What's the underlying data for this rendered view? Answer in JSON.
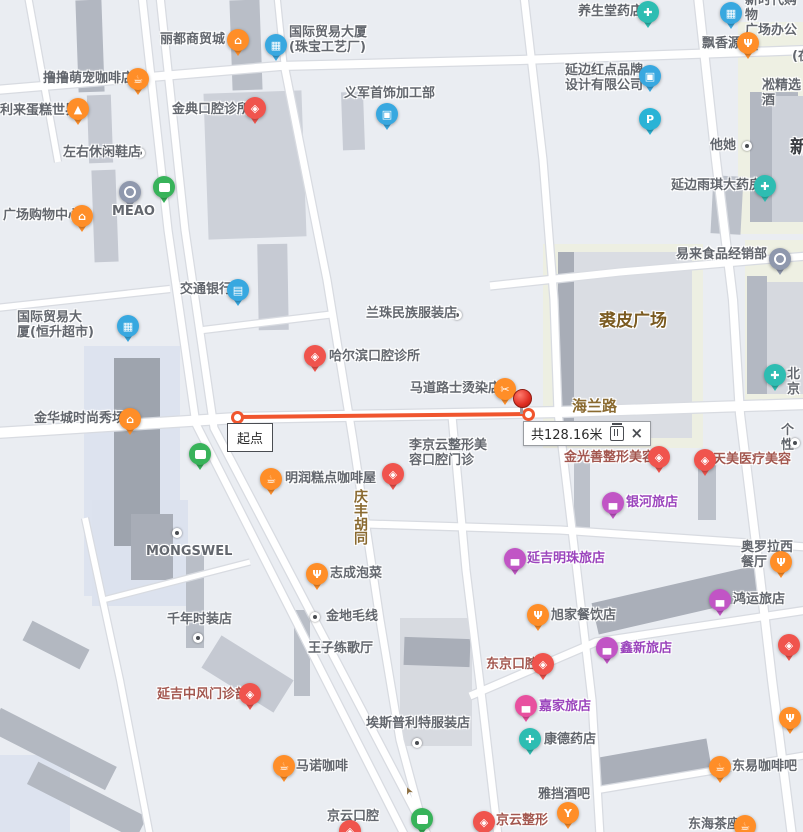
{
  "map": {
    "background": "#eaedf2",
    "road_fill": "#ffffff",
    "road_casing": "#d8dbe1",
    "palette": {
      "orange": "#ff8e28",
      "red": "#f0544d",
      "blue": "#38a8e0",
      "teal": "#2ebdb2",
      "tealP": "#2ab3d6",
      "green": "#38b35a",
      "purple": "#c155c5",
      "pink": "#e8509f",
      "grayblue": "#8f98ad"
    },
    "text_colors": {
      "gray": "#63676e",
      "purple": "#9b45bd",
      "medical": "#a3574f",
      "road": "#8a6a30",
      "plaza": "#7a5a20",
      "dark": "#3a3d42"
    }
  },
  "measurement": {
    "start_label": "起点",
    "distance_label": "共128.16米",
    "close_label": "×",
    "line_color": "#f0552e",
    "line": {
      "x1": 237,
      "y1": 417,
      "x2": 528,
      "y2": 414
    },
    "pushpin": {
      "x": 521,
      "y": 398
    }
  },
  "arrow": {
    "x": 405,
    "y": 785,
    "rot": -115,
    "glyph": "➤"
  },
  "icon_glyphs": {
    "bag": "⌂",
    "coffee": "☕",
    "cake": "▲",
    "restaurant": "Ψ",
    "scissors": "✂",
    "dental": "◈",
    "building": "▦",
    "briefcase": "▣",
    "card": "▤",
    "cross": "✚",
    "firstaid": "✚",
    "parking": "P",
    "bed": "▄",
    "cocktail": "Y"
  },
  "lots": [
    {
      "x": 543,
      "y": 244,
      "w": 160,
      "h": 204,
      "c": "#edefe2"
    },
    {
      "x": 738,
      "y": 22,
      "w": 65,
      "h": 212,
      "c": "#eef0e3"
    },
    {
      "x": 745,
      "y": 240,
      "w": 58,
      "h": 160,
      "c": "#eef0e3"
    },
    {
      "x": 84,
      "y": 346,
      "w": 96,
      "h": 250,
      "c": "#dde3ef"
    },
    {
      "x": 92,
      "y": 500,
      "w": 96,
      "h": 106,
      "c": "#dce2ee"
    },
    {
      "x": 0,
      "y": 755,
      "w": 70,
      "h": 77,
      "c": "#dde3ef"
    }
  ],
  "buildings": [
    {
      "x": 77,
      "y": 0,
      "w": 26,
      "h": 92,
      "c": "#b2b7c1",
      "r": -2
    },
    {
      "x": 231,
      "y": 0,
      "w": 30,
      "h": 90,
      "c": "#b9bec7",
      "r": -2
    },
    {
      "x": 88,
      "y": 95,
      "w": 24,
      "h": 68,
      "c": "#c5c9d2",
      "r": -2
    },
    {
      "x": 93,
      "y": 170,
      "w": 24,
      "h": 92,
      "c": "#c5c9d2",
      "r": -2
    },
    {
      "x": 206,
      "y": 92,
      "w": 98,
      "h": 146,
      "c": "#cdd1d9",
      "r": -2
    },
    {
      "x": 258,
      "y": 244,
      "w": 30,
      "h": 86,
      "c": "#c6cad3",
      "r": -1
    },
    {
      "x": 342,
      "y": 92,
      "w": 22,
      "h": 58,
      "c": "#c8ccd5",
      "r": -2
    },
    {
      "x": 558,
      "y": 252,
      "w": 16,
      "h": 186,
      "c": "#a8adb7",
      "r": 0
    },
    {
      "x": 574,
      "y": 252,
      "w": 118,
      "h": 186,
      "c": "#dadde3",
      "r": 0
    },
    {
      "x": 750,
      "y": 92,
      "w": 48,
      "h": 130,
      "c": "#b2b7c1",
      "r": 0
    },
    {
      "x": 772,
      "y": 96,
      "w": 31,
      "h": 126,
      "c": "#cdd1d9",
      "r": 0
    },
    {
      "x": 747,
      "y": 276,
      "w": 20,
      "h": 118,
      "c": "#b3b8c2",
      "r": 0
    },
    {
      "x": 767,
      "y": 282,
      "w": 36,
      "h": 112,
      "c": "#d6d9df",
      "r": 0
    },
    {
      "x": 712,
      "y": 176,
      "w": 30,
      "h": 58,
      "c": "#bcc1ca",
      "r": 3
    },
    {
      "x": 114,
      "y": 358,
      "w": 46,
      "h": 188,
      "c": "#9ea4ae",
      "r": 0
    },
    {
      "x": 131,
      "y": 514,
      "w": 42,
      "h": 66,
      "c": "#a8adb7",
      "r": 0
    },
    {
      "x": 186,
      "y": 552,
      "w": 18,
      "h": 96,
      "c": "#b9bec7",
      "r": 0
    },
    {
      "x": 294,
      "y": 610,
      "w": 16,
      "h": 86,
      "c": "#b9bec7",
      "r": 0
    },
    {
      "x": 400,
      "y": 618,
      "w": 72,
      "h": 128,
      "c": "#d7dae0",
      "r": 0
    },
    {
      "x": 404,
      "y": 638,
      "w": 66,
      "h": 28,
      "c": "#a9aeb8",
      "r": 2
    },
    {
      "x": 593,
      "y": 584,
      "w": 168,
      "h": 32,
      "c": "#aaafb9",
      "r": -13
    },
    {
      "x": 598,
      "y": 748,
      "w": 112,
      "h": 32,
      "c": "#aaafb9",
      "r": -10
    },
    {
      "x": 574,
      "y": 452,
      "w": 16,
      "h": 80,
      "c": "#bcc1ca",
      "r": 0
    },
    {
      "x": 698,
      "y": 464,
      "w": 18,
      "h": 56,
      "c": "#bcc1ca",
      "r": 0
    },
    {
      "x": 205,
      "y": 655,
      "w": 85,
      "h": 38,
      "c": "#c5c9d2",
      "r": 32
    },
    {
      "x": -12,
      "y": 736,
      "w": 130,
      "h": 26,
      "c": "#b3b8c1",
      "r": 27
    },
    {
      "x": 26,
      "y": 788,
      "w": 122,
      "h": 25,
      "c": "#b3b8c1",
      "r": 27
    },
    {
      "x": 24,
      "y": 634,
      "w": 64,
      "h": 22,
      "c": "#b3b8c1",
      "r": 27
    }
  ],
  "roads": [
    {
      "d": "M 28,-4 L 58,162",
      "w": 6
    },
    {
      "d": "M 142,-4 L 168,230 L 196,424 L 405,836",
      "w": 7
    },
    {
      "d": "M 160,-4 L 185,230 L 214,428 L 428,836",
      "w": 7
    },
    {
      "d": "M 277,-4 L 284,64",
      "w": 5
    },
    {
      "d": "M 284,64 L 327,280 L 353,440 L 380,620 L 400,740 L 426,836",
      "w": 7
    },
    {
      "d": "M 452,416 L 466,570 L 482,700 L 498,836",
      "w": 7
    },
    {
      "d": "M 524,-4 L 543,160 L 554,300 L 558,412",
      "w": 7
    },
    {
      "d": "M 558,412 L 578,580 L 592,700 L 600,836",
      "w": 7
    },
    {
      "d": "M 698,-4 L 716,160 L 733,300 L 740,414 L 758,560 L 772,680 L 792,836",
      "w": 8
    },
    {
      "d": "M -4,90 L 280,66 L 520,60 L 807,50",
      "w": 8
    },
    {
      "d": "M -4,433 L 237,418 L 560,412 L 807,404",
      "w": 10
    },
    {
      "d": "M 490,286 L 620,272 L 807,256",
      "w": 7
    },
    {
      "d": "M 367,524 L 560,530 L 807,547",
      "w": 7
    },
    {
      "d": "M 470,696 L 596,642 L 807,610",
      "w": 7
    },
    {
      "d": "M 598,790 L 807,755",
      "w": 6
    },
    {
      "d": "M 203,330 L 335,314",
      "w": 6
    },
    {
      "d": "M -4,308 L 170,289",
      "w": 6
    },
    {
      "d": "M 85,518 L 120,680 L 150,836",
      "w": 6
    },
    {
      "d": "M 103,600 L 250,562",
      "w": 5
    }
  ],
  "pois": [
    {
      "type": "pin",
      "label": "丽都商贸城",
      "icon": "bag",
      "pin": "orange",
      "tc": "gray",
      "x": 238,
      "y": 40,
      "lx": 160,
      "ly": 32
    },
    {
      "type": "pin",
      "label": "国际贸易大厦\n(珠宝工艺厂)",
      "icon": "building",
      "pin": "blue",
      "tc": "gray",
      "x": 276,
      "y": 45,
      "lx": 289,
      "ly": 25
    },
    {
      "type": "pin",
      "label": "养生堂药店",
      "icon": "cross",
      "pin": "teal",
      "tc": "gray",
      "x": 648,
      "y": 12,
      "lx": 578,
      "ly": 4
    },
    {
      "type": "pin",
      "label": "新时代购物\n广场办公区",
      "icon": "building",
      "pin": "blue",
      "tc": "gray",
      "x": 731,
      "y": 13,
      "lx": 745,
      "ly": -7
    },
    {
      "type": "pin",
      "label": "飘香源",
      "icon": "restaurant",
      "pin": "orange",
      "tc": "gray",
      "x": 748,
      "y": 43,
      "lx": 702,
      "ly": 36
    },
    {
      "type": "pin",
      "label": "撸撸萌宠咖啡店",
      "icon": "coffee",
      "pin": "orange",
      "tc": "gray",
      "x": 138,
      "y": 79,
      "lx": 43,
      "ly": 71
    },
    {
      "type": "pin",
      "label": "延边红点品牌\n设计有限公司",
      "icon": "briefcase",
      "pin": "blue",
      "tc": "gray",
      "x": 650,
      "y": 76,
      "lx": 565,
      "ly": 63
    },
    {
      "type": "pin",
      "label": "利来蛋糕世界",
      "icon": "cake",
      "pin": "orange",
      "tc": "gray",
      "x": 78,
      "y": 109,
      "lx": 0,
      "ly": 103
    },
    {
      "type": "pin",
      "label": "金典口腔诊所",
      "icon": "dental",
      "pin": "red",
      "tc": "gray",
      "x": 255,
      "y": 108,
      "lx": 172,
      "ly": 102
    },
    {
      "type": "pin",
      "label": "义军首饰加工部",
      "icon": "briefcase",
      "pin": "blue",
      "tc": "gray",
      "x": 387,
      "y": 114,
      "lx": 344,
      "ly": 86
    },
    {
      "type": "pin",
      "label": "",
      "icon": "parking",
      "pin": "tealP",
      "tc": "gray",
      "x": 650,
      "y": 119,
      "lx": 0,
      "ly": 0
    },
    {
      "type": "dot",
      "label": "左右休闲鞋店",
      "tc": "gray",
      "x": 140,
      "y": 153,
      "lx": 63,
      "ly": 145
    },
    {
      "type": "dot",
      "label": "他她",
      "tc": "gray",
      "x": 747,
      "y": 146,
      "lx": 710,
      "ly": 138
    },
    {
      "type": "pin",
      "label": "",
      "icon": "bus",
      "pin": "green",
      "tc": "gray",
      "x": 164,
      "y": 187,
      "lx": 0,
      "ly": 0
    },
    {
      "type": "pin",
      "label": "MEAO",
      "icon": "circlemark",
      "pin": "grayblue",
      "tc": "gray",
      "x": 130,
      "y": 192,
      "lx": 112,
      "ly": 204
    },
    {
      "type": "pin",
      "label": "广场购物中心",
      "icon": "bag",
      "pin": "orange",
      "tc": "gray",
      "x": 82,
      "y": 216,
      "lx": 3,
      "ly": 208
    },
    {
      "type": "pin",
      "label": "延边雨琪大药房",
      "icon": "firstaid",
      "pin": "teal",
      "tc": "gray",
      "x": 765,
      "y": 186,
      "lx": 671,
      "ly": 178
    },
    {
      "type": "pin",
      "label": "交通银行",
      "icon": "card",
      "pin": "blue",
      "tc": "gray",
      "x": 238,
      "y": 290,
      "lx": 180,
      "ly": 282
    },
    {
      "type": "pin",
      "label": "国际贸易大\n厦(恒升超市)",
      "icon": "building",
      "pin": "blue",
      "tc": "gray",
      "x": 128,
      "y": 326,
      "lx": 17,
      "ly": 310
    },
    {
      "type": "pin",
      "label": "易来食品经销部",
      "icon": "circlemark",
      "pin": "grayblue",
      "tc": "gray",
      "x": 780,
      "y": 259,
      "lx": 676,
      "ly": 247
    },
    {
      "type": "dot",
      "label": "兰珠民族服装店",
      "tc": "gray",
      "x": 457,
      "y": 315,
      "lx": 366,
      "ly": 306
    },
    {
      "type": "pin",
      "label": "哈尔滨口腔诊所",
      "icon": "dental",
      "pin": "red",
      "tc": "gray",
      "x": 315,
      "y": 356,
      "lx": 329,
      "ly": 349
    },
    {
      "type": "pin",
      "label": "北京",
      "icon": "firstaid",
      "pin": "teal",
      "tc": "gray",
      "x": 775,
      "y": 375,
      "lx": 787,
      "ly": 367
    },
    {
      "type": "pin",
      "label": "马道路士烫染店",
      "icon": "scissors",
      "pin": "orange",
      "tc": "gray",
      "x": 505,
      "y": 389,
      "lx": 410,
      "ly": 381
    },
    {
      "type": "pin",
      "label": "金华城时尚秀场",
      "icon": "bag",
      "pin": "orange",
      "tc": "gray",
      "x": 130,
      "y": 419,
      "lx": 34,
      "ly": 411
    },
    {
      "type": "pin",
      "label": "",
      "icon": "bus",
      "pin": "green",
      "tc": "gray",
      "x": 200,
      "y": 454,
      "lx": 0,
      "ly": 0
    },
    {
      "type": "pin",
      "label": "金光善整形美容",
      "icon": "dental",
      "pin": "red",
      "tc": "medical",
      "x": 659,
      "y": 457,
      "lx": 564,
      "ly": 450
    },
    {
      "type": "pin",
      "label": "天美医疗美容",
      "icon": "dental",
      "pin": "red",
      "tc": "medical",
      "x": 705,
      "y": 460,
      "lx": 713,
      "ly": 452
    },
    {
      "type": "pin",
      "label": "李京云整形美\n容口腔门诊",
      "icon": "dental",
      "pin": "red",
      "tc": "gray",
      "x": 393,
      "y": 474,
      "lx": 409,
      "ly": 438
    },
    {
      "type": "pin",
      "label": "明润糕点咖啡屋",
      "icon": "coffee",
      "pin": "orange",
      "tc": "gray",
      "x": 271,
      "y": 479,
      "lx": 285,
      "ly": 471
    },
    {
      "type": "pin",
      "label": "银河旅店",
      "icon": "bed",
      "pin": "purple",
      "tc": "purple",
      "x": 613,
      "y": 503,
      "lx": 626,
      "ly": 495
    },
    {
      "type": "pin",
      "label": "奥罗拉西餐厅",
      "icon": "restaurant",
      "pin": "orange",
      "tc": "gray",
      "x": 781,
      "y": 562,
      "lx": 741,
      "ly": 540
    },
    {
      "type": "pin",
      "label": "延吉明珠旅店",
      "icon": "bed",
      "pin": "purple",
      "tc": "purple",
      "x": 515,
      "y": 559,
      "lx": 527,
      "ly": 551
    },
    {
      "type": "dot",
      "label": "MONGSWEL",
      "tc": "gray",
      "x": 177,
      "y": 533,
      "lx": 146,
      "ly": 544
    },
    {
      "type": "pin",
      "label": "志成泡菜",
      "icon": "restaurant",
      "pin": "orange",
      "tc": "gray",
      "x": 317,
      "y": 574,
      "lx": 330,
      "ly": 566
    },
    {
      "type": "pin",
      "label": "旭家餐饮店",
      "icon": "restaurant",
      "pin": "orange",
      "tc": "gray",
      "x": 538,
      "y": 615,
      "lx": 551,
      "ly": 608
    },
    {
      "type": "pin",
      "label": "鸿运旅店",
      "icon": "bed",
      "pin": "purple",
      "tc": "gray",
      "x": 720,
      "y": 600,
      "lx": 733,
      "ly": 592
    },
    {
      "type": "dot",
      "label": "千年时装店",
      "tc": "gray",
      "x": 198,
      "y": 638,
      "lx": 167,
      "ly": 612
    },
    {
      "type": "dot",
      "label": "金地毛线",
      "tc": "gray",
      "x": 315,
      "y": 617,
      "lx": 326,
      "ly": 609
    },
    {
      "type": "pin",
      "label": "鑫新旅店",
      "icon": "bed",
      "pin": "purple",
      "tc": "purple",
      "x": 607,
      "y": 648,
      "lx": 620,
      "ly": 641
    },
    {
      "type": "text",
      "label": "王子练歌厅",
      "tc": "gray",
      "x": 0,
      "y": 0,
      "lx": 308,
      "ly": 641
    },
    {
      "type": "pin",
      "label": "东京口腔",
      "icon": "dental",
      "pin": "red",
      "tc": "medical",
      "x": 543,
      "y": 664,
      "lx": 486,
      "ly": 657
    },
    {
      "type": "pin",
      "label": "",
      "icon": "dental",
      "pin": "red",
      "tc": "gray",
      "x": 789,
      "y": 645,
      "lx": 0,
      "ly": 0
    },
    {
      "type": "pin",
      "label": "延吉中风门诊部",
      "icon": "dental",
      "pin": "red",
      "tc": "medical",
      "x": 250,
      "y": 694,
      "lx": 157,
      "ly": 687
    },
    {
      "type": "pin",
      "label": "嘉家旅店",
      "icon": "bed",
      "pin": "pink",
      "tc": "purple",
      "x": 526,
      "y": 706,
      "lx": 539,
      "ly": 699
    },
    {
      "type": "dot",
      "label": "埃斯普利特服装店",
      "tc": "gray",
      "x": 417,
      "y": 743,
      "lx": 366,
      "ly": 716
    },
    {
      "type": "pin",
      "label": "康德药店",
      "icon": "firstaid",
      "pin": "teal",
      "tc": "gray",
      "x": 530,
      "y": 739,
      "lx": 544,
      "ly": 732
    },
    {
      "type": "pin",
      "label": "东易咖啡吧",
      "icon": "coffee",
      "pin": "orange",
      "tc": "gray",
      "x": 720,
      "y": 767,
      "lx": 732,
      "ly": 759
    },
    {
      "type": "pin",
      "label": "马诺咖啡",
      "icon": "coffee",
      "pin": "orange",
      "tc": "gray",
      "x": 284,
      "y": 766,
      "lx": 296,
      "ly": 759
    },
    {
      "type": "pin",
      "label": "",
      "icon": "restaurant",
      "pin": "orange",
      "tc": "gray",
      "x": 790,
      "y": 718,
      "lx": 0,
      "ly": 0
    },
    {
      "type": "pin",
      "label": "雅挡酒吧",
      "icon": "cocktail",
      "pin": "orange",
      "tc": "gray",
      "x": 568,
      "y": 813,
      "lx": 538,
      "ly": 787
    },
    {
      "type": "text",
      "label": "京云口腔",
      "tc": "gray",
      "x": 0,
      "y": 0,
      "lx": 327,
      "ly": 809
    },
    {
      "type": "pin",
      "label": "",
      "icon": "dental",
      "pin": "red",
      "tc": "gray",
      "x": 350,
      "y": 831,
      "lx": 0,
      "ly": 0
    },
    {
      "type": "pin",
      "label": "",
      "icon": "bus",
      "pin": "green",
      "tc": "gray",
      "x": 422,
      "y": 819,
      "lx": 0,
      "ly": 0
    },
    {
      "type": "pin",
      "label": "京云整形",
      "icon": "dental",
      "pin": "red",
      "tc": "medical",
      "x": 484,
      "y": 822,
      "lx": 496,
      "ly": 813
    },
    {
      "type": "pin",
      "label": "东海茶座",
      "icon": "coffee",
      "pin": "orange",
      "tc": "gray",
      "x": 745,
      "y": 826,
      "lx": 688,
      "ly": 817
    },
    {
      "type": "text",
      "label": "(在",
      "tc": "gray",
      "x": 0,
      "y": 0,
      "lx": 792,
      "ly": 49
    },
    {
      "type": "text",
      "label": "凇精选酒",
      "tc": "gray",
      "x": 0,
      "y": 0,
      "lx": 762,
      "ly": 78
    },
    {
      "type": "text",
      "label": "新",
      "tc": "dark",
      "x": 0,
      "y": 0,
      "lx": 790,
      "ly": 140,
      "fs": 18
    },
    {
      "type": "text",
      "label": "个性",
      "tc": "gray",
      "x": 0,
      "y": 0,
      "lx": 781,
      "ly": 423
    },
    {
      "type": "dot",
      "label": "",
      "tc": "gray",
      "x": 795,
      "y": 443,
      "lx": 0,
      "ly": 0
    },
    {
      "type": "text",
      "label": "海兰路",
      "tc": "road",
      "x": 0,
      "y": 0,
      "lx": 572,
      "ly": 399,
      "fs": 15
    },
    {
      "type": "vtext",
      "label": "庆丰胡同",
      "tc": "road",
      "x": 0,
      "y": 0,
      "lx": 352,
      "ly": 489,
      "fs": 14
    },
    {
      "type": "text",
      "label": "裘皮广场",
      "tc": "plaza",
      "x": 0,
      "y": 0,
      "lx": 599,
      "ly": 314,
      "fs": 17
    }
  ]
}
